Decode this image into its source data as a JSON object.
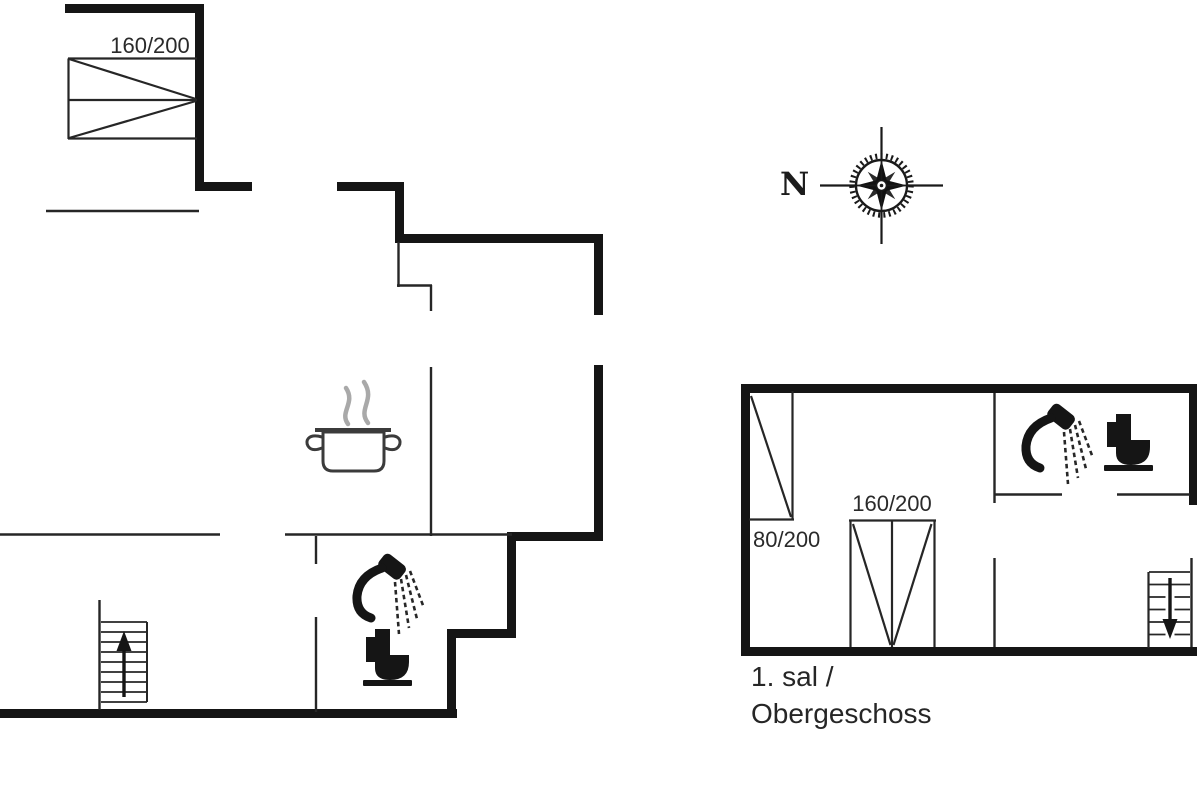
{
  "canvas": {
    "background": "#ffffff",
    "wall_color": "#151515",
    "thin_line_color": "#262626",
    "steam_color": "#a9a9a9"
  },
  "compass": {
    "north_label": "N",
    "icon": "compass-rose-icon"
  },
  "ground_floor": {
    "double_bed_label": "160/200",
    "icons": [
      "double-bed-icon",
      "cooking-pot-icon",
      "shower-icon",
      "toilet-icon",
      "stairs-up-icon"
    ]
  },
  "upper_floor": {
    "caption_line1": "1. sal /",
    "caption_line2": "Obergeschoss",
    "single_bed_label": "80/200",
    "double_bed_label": "160/200",
    "icons": [
      "single-bed-icon",
      "double-bed-icon",
      "shower-icon",
      "toilet-icon",
      "stairs-down-icon"
    ]
  }
}
